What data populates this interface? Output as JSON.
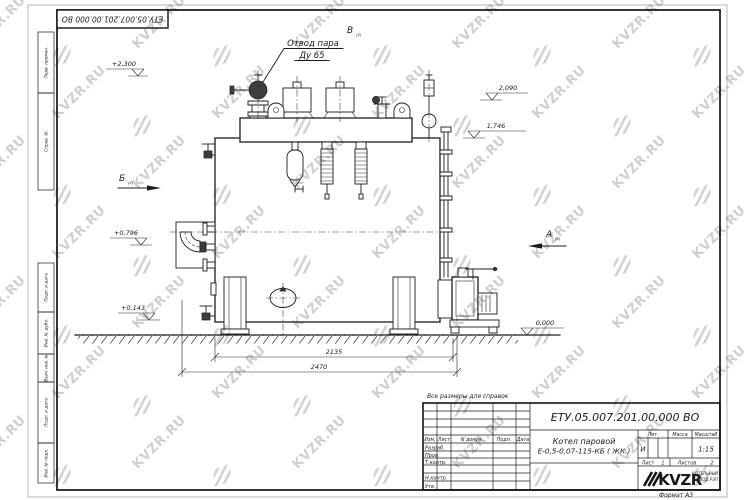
{
  "watermark": {
    "text": "KVZR.RU"
  },
  "frame": {
    "doc_number_top": "ЕТУ.05.007.201.00.000  ВО",
    "margin_labels": [
      "Перв. примен.",
      "Справ. №",
      "Подп. и дата",
      "Инв. № дубл.",
      "Взам. инв. №",
      "Подп. и дата",
      "Инв. № подл."
    ],
    "format_note": "Формат А3"
  },
  "drawing": {
    "callout_line1": "Отвод пара",
    "callout_line2": "Ду 65",
    "view_v": "В",
    "view_b": "Б",
    "view_a": "А",
    "view_ref": "(2)",
    "elev_plus2300": "+2,300",
    "elev_2090": "2,090",
    "elev_1746": "1,746",
    "elev_plus0796": "+0,796",
    "elev_plus0143": "+0,143",
    "elev_0000": "0,000",
    "dim_2135": "2135",
    "dim_2470": "2470",
    "ref_note": "Все размеры для справок"
  },
  "title_block": {
    "doc_number": "ЕТУ.05.007.201.00.000  ВО",
    "name_line1": "Котел паровой",
    "name_line2": "Е-0,5-0,07-115-КБ ( ЖК )",
    "col_izm": "Изм.",
    "col_list": "Лист",
    "col_ndoc": "N докум.",
    "col_podp": "Подп.",
    "col_data": "Дата",
    "row_razrab": "Разраб.",
    "row_prov": "Пров.",
    "row_tkontr": "Т.контр.",
    "row_nkontr": "Н.контр.",
    "row_utv": "Утв.",
    "lit_label": "Лит.",
    "mass_label": "Масса",
    "scale_label": "Масштаб",
    "lit_value": "И",
    "scale_value": "1:15",
    "sheet_label": "Лист",
    "sheet_value": "1",
    "sheets_label": "Листов",
    "sheets_value": "2",
    "logo_text": "KVZR",
    "logo_caption1": "КОТЕЛЬНЫЙ",
    "logo_caption2": "ЗАВОД РЭП"
  }
}
